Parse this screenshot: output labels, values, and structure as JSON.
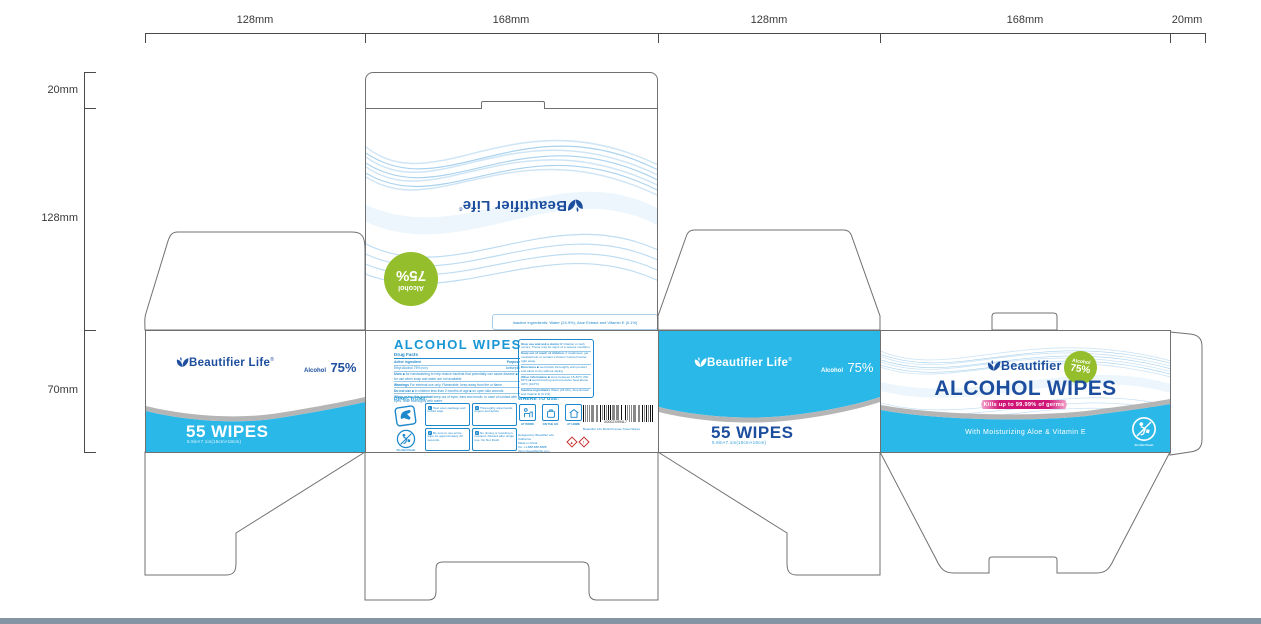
{
  "dimensions": {
    "top": [
      "128mm",
      "168mm",
      "128mm",
      "168mm",
      "20mm"
    ],
    "side": [
      "20mm",
      "128mm",
      "70mm"
    ]
  },
  "brand": {
    "name": "Beautifier Life",
    "reg": "®",
    "alcohol": "Alcohol",
    "percent": "75%"
  },
  "top_panel": {
    "inactive": "Inactive ingredients: Water (24.9%), Aloe Extract and Vitamin E (0.1%)"
  },
  "side_panel": {
    "count": "55 WIPES",
    "size": "5.9in×7.1in(15cm×18cm)"
  },
  "front": {
    "title": "ALCOHOL WIPES",
    "df_title": "Drug Facts",
    "df_active_label": "Active ingredient",
    "df_purpose_label": "Purpose",
    "df_active": "Ethyl Alcohol 75% (v/v)",
    "df_purpose": "Antiseptic",
    "df_uses_label": "Uses",
    "df_uses": "■ for handwashing to help reduce bacteria that potentially can cause disease ■ for use when soap and water are not available",
    "df_warn_label": "Warnings",
    "df_warn": "For external use only. Flammable, keep away from fire or flame.",
    "df_dnu_label": "Do not use",
    "df_dnu": "■ in children less than 2 months of age ■ on open skin wounds",
    "df_when_label": "When using this product",
    "df_when": "keep out of eyes, ears and mouth. In case of contact with eyes, rinse thoroughly with water.",
    "df_stop_label": "Stop use and ask a doctor if",
    "df_stop": "irritation or rash occurs. These may be signs of a serious condition.",
    "df_keep_label": "Keep out of reach of children.",
    "df_keep": "If swallowed, get medical help or contact a Poison Control Center right away.",
    "df_dir_label": "Directions",
    "df_dir": "■ wet hands thoroughly with product and allow to dry without wiping",
    "df_other_label": "Other information",
    "df_other": "■ store between 15-30°C (59-86°F) ■ avoid freezing and excessive heat above 40°C (104°F)",
    "df_inactive_label": "Inactive ingredients",
    "df_inactive": "Water (24.9%), Aloe Extract and Vitamin E (0.1%)",
    "dir_label": "DIRECTIONS:",
    "steps": {
      "s1_num": "1",
      "s1": "Tear open package and unfold wipe.",
      "s2_num": "3",
      "s2": "Thoroughly wipe hands, fingers and article.",
      "s3_num": "2",
      "s3": "Be sure to use entire wipe for approximately 20 seconds.",
      "s4_num": "4",
      "s4": "No rinsing or toweling is required. Discard after single use. Do Not Flush."
    },
    "dnf": "Do Not Flush",
    "wtu_label": "WHERE TO USE:",
    "wtu1": "AT WORK",
    "wtu2": "ON THE GO",
    "wtu3": "AT HOME",
    "contact1": "Designed by Beautifier Life California",
    "contact2": "Made in China",
    "contact3": "Tel: +1-888-888-8888",
    "contact4": "https://beautifierlife.com",
    "barcode_num": "X000ZX994L7",
    "barcode_caption": "Beautifier Life Multi-Purpose Towel Wipes"
  },
  "back": {
    "title": "ALCOHOL WIPES",
    "ribbon": "Kills up to 99.99% of germs",
    "tagline": "With Moisturizing Aloe & Vitamin E",
    "dnf": "Do Not Flush"
  },
  "colors": {
    "cyan": "#29B8E8",
    "brand_blue": "#1D4E9E",
    "front_blue": "#1E88CC",
    "green": "#94BE2B",
    "magenta": "#CF1576",
    "swoosh_gray": "#B5B5B5",
    "dieline": "#707070"
  }
}
